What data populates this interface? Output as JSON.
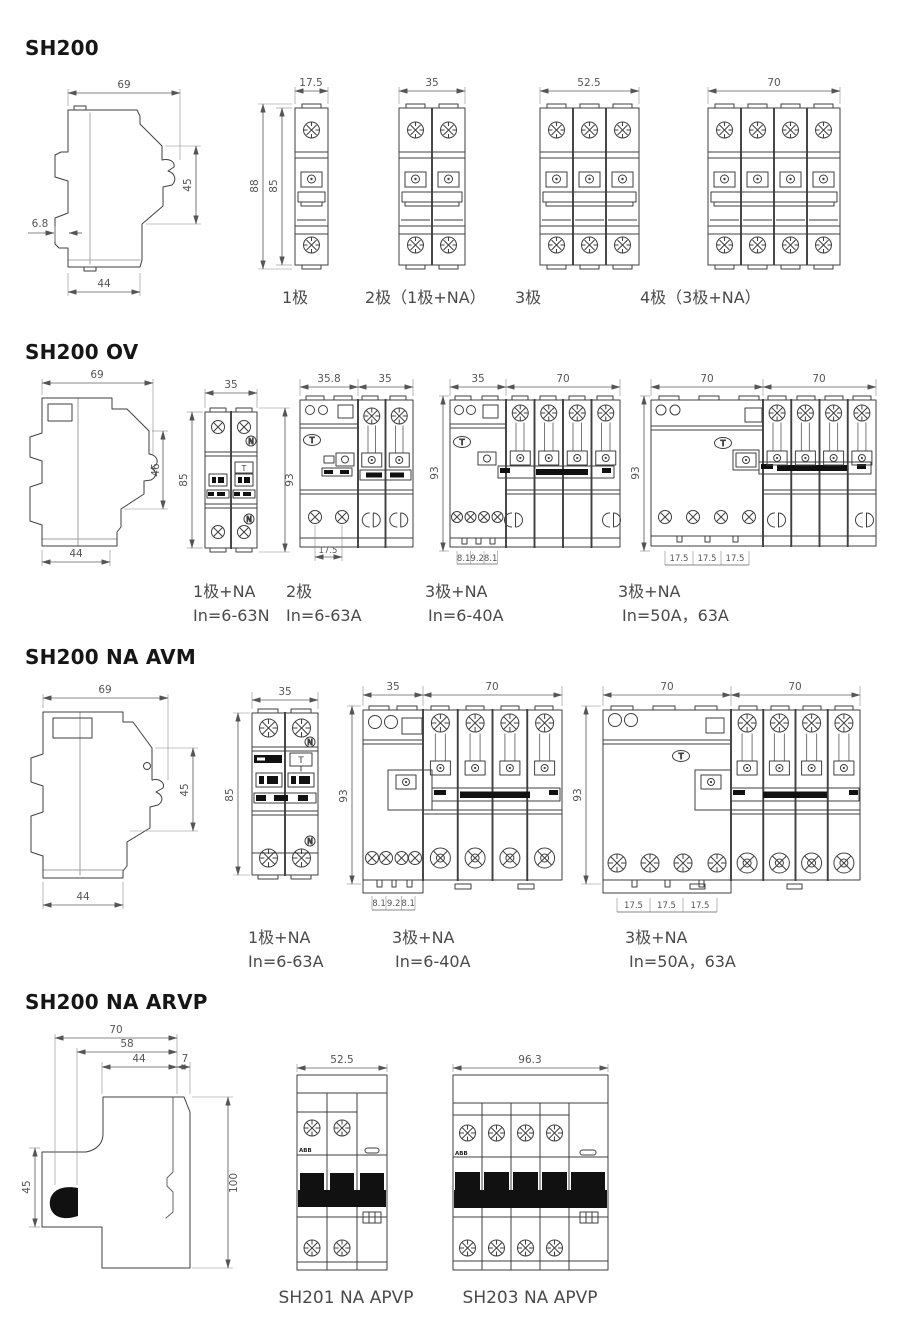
{
  "page": {
    "background": "#ffffff",
    "line_color": "#3f3f3f",
    "dim_color": "#555555"
  },
  "glyphs": {
    "test_button": "T",
    "neutral_marker": "N",
    "brand": "ABB"
  },
  "sections": [
    {
      "title": "SH200",
      "side_dims": {
        "top": "69",
        "front_height": "45",
        "clip_depth": "6.8",
        "base_depth": "44"
      },
      "fronts": [
        {
          "caption": "1极",
          "width": "17.5",
          "height_outer": "88",
          "height_inner": "85"
        },
        {
          "caption": "2极（1极+NA）",
          "width": "35"
        },
        {
          "caption": "3极",
          "width": "52.5"
        },
        {
          "caption": "4极（3极+NA）",
          "width": "70"
        }
      ]
    },
    {
      "title": "SH200 OV",
      "side_dims": {
        "top": "69",
        "front_height": "46",
        "base_depth": "44"
      },
      "fronts": [
        {
          "caption": "1极+NA",
          "rating": "In=6-63N",
          "width": "35",
          "height_left": "85",
          "height_right": "93"
        },
        {
          "caption": "2极",
          "rating": "In=6-63A",
          "width_left": "35.8",
          "width_right": "35",
          "bottom_dims": [
            "17.5"
          ]
        },
        {
          "caption": "3极+NA",
          "rating": "In=6-40A",
          "width_left": "35",
          "width_right": "70",
          "height": "93",
          "bottom_dims": [
            "8.1",
            "9.2",
            "8.1"
          ]
        },
        {
          "caption": "3极+NA",
          "rating": "In=50A，63A",
          "width_left": "70",
          "width_right": "70",
          "height": "93",
          "bottom_dims": [
            "17.5",
            "17.5",
            "17.5"
          ]
        }
      ]
    },
    {
      "title": "SH200 NA AVM",
      "side_dims": {
        "top": "69",
        "front_height": "45",
        "base_depth": "44"
      },
      "fronts": [
        {
          "caption": "1极+NA",
          "rating": "In=6-63A",
          "width": "35",
          "height_left": "85"
        },
        {
          "caption": "3极+NA",
          "rating": "In=6-40A",
          "width_left": "35",
          "width_right": "70",
          "height": "93",
          "bottom_dims": [
            "8.1",
            "9.2",
            "8.1"
          ]
        },
        {
          "caption": "3极+NA",
          "rating": "In=50A，63A",
          "width_left": "70",
          "width_right": "70",
          "height": "93",
          "bottom_dims": [
            "17.5",
            "17.5",
            "17.5"
          ]
        }
      ]
    },
    {
      "title": "SH200 NA ARVP",
      "side_dims": {
        "top": "70",
        "mid": "58",
        "base": "44",
        "lip": "7",
        "handle_height": "45",
        "total_height": "100"
      },
      "fronts": [
        {
          "caption": "SH201 NA APVP",
          "width": "52.5"
        },
        {
          "caption": "SH203 NA APVP",
          "width": "96.3"
        }
      ]
    }
  ]
}
